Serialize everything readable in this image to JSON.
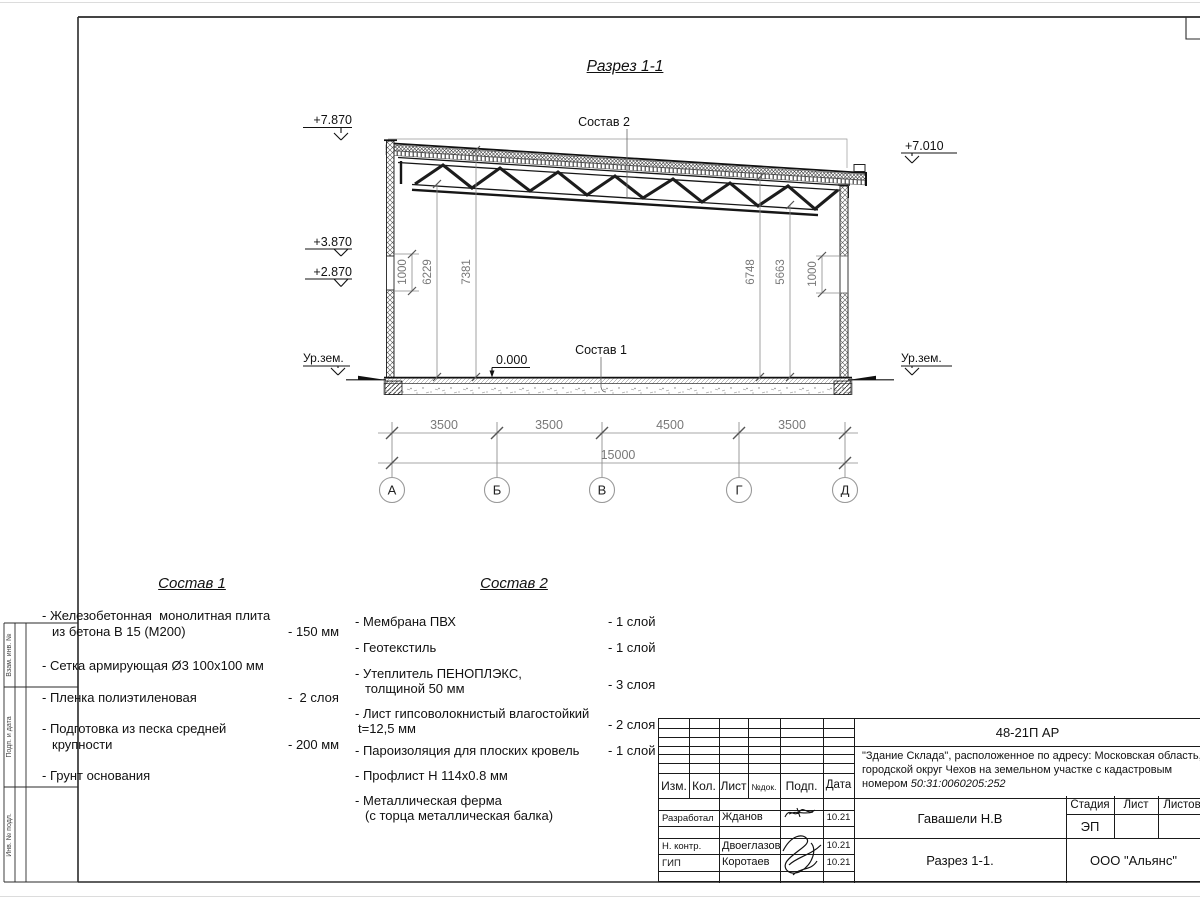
{
  "drawing": {
    "title": "Разрез 1-1",
    "marks": {
      "lvl_top_left": "+7.870",
      "lvl_mid_left": "+3.870",
      "lvl_low_left": "+2.870",
      "lvl_top_right": "+7.010",
      "lvl_zero": "0.000",
      "ground_left": "Ур.зем.",
      "ground_right": "Ур.зем."
    },
    "callouts": {
      "roof": "Состав 2",
      "floor": "Состав 1"
    },
    "vdims": [
      "1000",
      "6229",
      "7381",
      "6748",
      "5663",
      "1000"
    ],
    "hdims": [
      "3500",
      "3500",
      "4500",
      "3500"
    ],
    "total": "15000",
    "axes": [
      "А",
      "Б",
      "В",
      "Г",
      "Д"
    ]
  },
  "margin_labels": [
    "Взам. инв. №",
    "Подп. и дата",
    "Инв. № подл."
  ],
  "comp1": {
    "title": "Состав 1",
    "items": [
      {
        "l1": "- Железобетонная  монолитная плита",
        "l2": "из бетона В 15 (М200)",
        "v": "- 150 мм"
      },
      {
        "l1": "- Сетка армирующая Ø3 100х100 мм",
        "l2": "",
        "v": ""
      },
      {
        "l1": "- Пленка полиэтиленовая",
        "l2": "",
        "v": "-  2 слоя"
      },
      {
        "l1": "- Подготовка из песка средней",
        "l2": "крупности",
        "v": "- 200 мм"
      },
      {
        "l1": "- Грунт основания",
        "l2": "",
        "v": ""
      }
    ]
  },
  "comp2": {
    "title": "Состав 2",
    "items": [
      {
        "l1": "- Мембрана ПВХ",
        "l2": "",
        "v": "- 1 слой"
      },
      {
        "l1": "- Геотекстиль",
        "l2": "",
        "v": "- 1 слой"
      },
      {
        "l1": "- Утеплитель ПЕНОПЛЭКС,",
        "l2": "толщиной 50 мм",
        "v": "- 3 слоя"
      },
      {
        "l1": "- Лист гипсоволокнистый влагостойкий",
        "l2": "t=12,5 мм",
        "v": "- 2 слоя"
      },
      {
        "l1": "- Пароизоляция для плоских кровель",
        "l2": "",
        "v": "- 1 слой"
      },
      {
        "l1": "- Профлист Н 114х0.8 мм",
        "l2": "",
        "v": ""
      },
      {
        "l1": "- Металлическая ферма",
        "l2": "(с торца металлическая балка)",
        "v": ""
      }
    ]
  },
  "titleblock": {
    "doc_number": "48-21П АР",
    "project": {
      "line1": "\"Здание Склада\", расположенное по адресу: Московская область,",
      "line2": "городской округ Чехов на земельном участке с кадастровым",
      "line3_prefix": "номером ",
      "cadastral": "50:31:0060205:252"
    },
    "columns": {
      "izm": "Изм.",
      "kol": "Кол.",
      "list": "Лист",
      "ndok": "№док.",
      "podp": "Подп.",
      "data": "Дата"
    },
    "rows": [
      {
        "role": "Разработал",
        "name": "Жданов",
        "date": "10.21"
      },
      {
        "role": "Н. контр.",
        "name": "Двоеглазов",
        "date": "10.21"
      },
      {
        "role": "ГИП",
        "name": "Коротаев",
        "date": "10.21"
      }
    ],
    "approver": "Гавашели Н.В",
    "stage_label": "Стадия",
    "sheet_label": "Лист",
    "sheets_label": "Листов",
    "stage": "ЭП",
    "sheet_title": "Разрез 1-1.",
    "company": "ООО \"Альянс\""
  }
}
